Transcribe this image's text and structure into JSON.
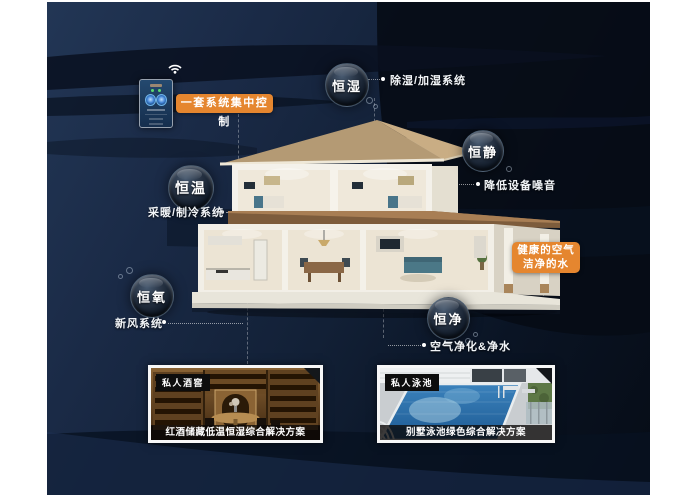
{
  "colors": {
    "accent_orange": "#e5862f",
    "background_navy": "#14233c",
    "wave_dark": "#091120",
    "label_white": "#f2f5f8"
  },
  "controller": {
    "banner_label": "一套系统集中控制",
    "wifi_icon": "wifi-icon",
    "panel_icon": "smart-control-panel"
  },
  "bubbles": [
    {
      "label": "恒湿",
      "desc": "除湿/加湿系统"
    },
    {
      "label": "恒静",
      "desc": "降低设备噪音"
    },
    {
      "label": "恒温",
      "desc": "采暖/制冷系统"
    },
    {
      "label": "恒氧",
      "desc": "新风系统"
    },
    {
      "label": "恒净",
      "desc": "空气净化&净水"
    }
  ],
  "highlight_box": {
    "line1": "健康的空气",
    "line2": "洁净的水"
  },
  "cards": [
    {
      "tag": "私人酒窖",
      "caption": "红酒储藏低温恒湿综合解决方案"
    },
    {
      "tag": "私人泳池",
      "caption": "别墅泳池绿色综合解决方案"
    }
  ]
}
